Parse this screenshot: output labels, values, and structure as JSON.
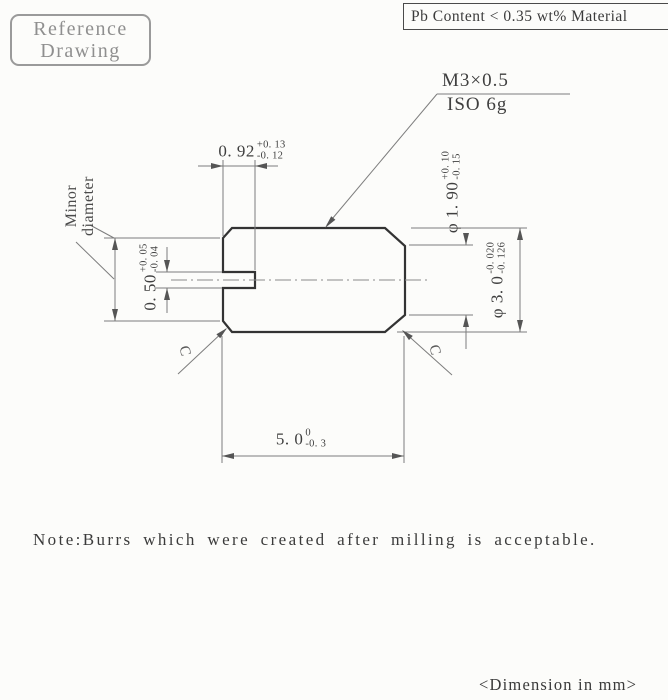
{
  "stamp": {
    "line1": "Reference",
    "line2": "Drawing"
  },
  "material_note": "Pb Content < 0.35 wt% Material",
  "thread_callout": {
    "line1": "M3×0.5",
    "line2": "ISO 6g"
  },
  "labels": {
    "minor_diameter_line1": "Minor",
    "minor_diameter_line2": "diameter",
    "chamfer": "C"
  },
  "dimensions": {
    "slot_depth": {
      "value": "0. 92",
      "upper": "+0. 13",
      "lower": "-0. 12"
    },
    "slot_width": {
      "value": "0. 50",
      "upper": "+0. 05",
      "lower": "-0. 04"
    },
    "tip_diameter": {
      "value": "φ 1. 90",
      "upper": "+0. 10",
      "lower": "-0. 15"
    },
    "body_diameter": {
      "value": "φ 3. 0",
      "upper": "-0. 020",
      "lower": "-0. 126"
    },
    "overall_length": {
      "value": "5. 0",
      "upper": "0",
      "lower": "-0. 3"
    }
  },
  "note": "Note:Burrs which were created after milling is acceptable.",
  "footer": "<Dimension in mm>",
  "colors": {
    "background": "#fcfcfa",
    "outline": "#333333",
    "thin_line": "#7d7d7d",
    "stamp_gray": "#8f8f8f",
    "text": "#3f3f3f"
  }
}
